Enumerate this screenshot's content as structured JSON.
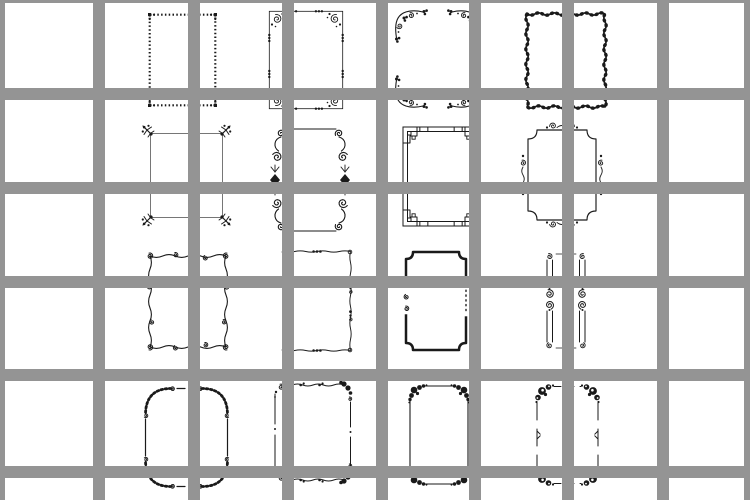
{
  "canvas": {
    "width": 750,
    "height": 500,
    "background": "#ffffff",
    "ink": "#1a1a1a",
    "thin_line": "#4a4a4a"
  },
  "grid_overlay": {
    "description": "opaque gray window-pane grid drawn on top of the clipart sheet",
    "color": "#949494",
    "bar_thickness": 12,
    "vertical_bars_x": [
      -7,
      93,
      188,
      282,
      376,
      469,
      562,
      657,
      744
    ],
    "horizontal_bars_y": [
      -9,
      88,
      182,
      276,
      369,
      466
    ]
  },
  "sheet": {
    "description": "4x4 sheet of black ornamental vintage frame cliparts on white",
    "rows": 4,
    "columns": 4
  },
  "frames": [
    {
      "name": "frame-beaded-dotted",
      "kind": "bead_rect",
      "x": 148,
      "y": 13,
      "w": 69,
      "h": 94
    },
    {
      "name": "frame-corner-scroll-bead",
      "kind": "scroll_bead",
      "x": 268,
      "y": 10,
      "w": 76,
      "h": 100
    },
    {
      "name": "frame-floral-corner-vine",
      "kind": "vine_corners",
      "x": 393,
      "y": 8,
      "w": 89,
      "h": 102
    },
    {
      "name": "frame-leafy-wave-border",
      "kind": "leafy_wave",
      "x": 524,
      "y": 11,
      "w": 84,
      "h": 99
    },
    {
      "name": "frame-branch-corner",
      "kind": "branch_corners",
      "x": 141,
      "y": 124,
      "w": 91,
      "h": 103
    },
    {
      "name": "frame-s-scroll-diamond",
      "kind": "scroll_diamond",
      "x": 268,
      "y": 127,
      "w": 84,
      "h": 106
    },
    {
      "name": "frame-greek-key",
      "kind": "greek_key",
      "x": 402,
      "y": 126,
      "w": 78,
      "h": 101
    },
    {
      "name": "frame-notched-plaque",
      "kind": "plaque_scroll",
      "x": 518,
      "y": 121,
      "w": 88,
      "h": 108
    },
    {
      "name": "frame-curly-squiggle",
      "kind": "squiggle_curls",
      "x": 144,
      "y": 250,
      "w": 88,
      "h": 103
    },
    {
      "name": "frame-wavy-bead",
      "kind": "wavy_bead",
      "x": 280,
      "y": 248,
      "w": 74,
      "h": 106
    },
    {
      "name": "frame-bold-notched",
      "kind": "bold_notched",
      "x": 403,
      "y": 250,
      "w": 66,
      "h": 102
    },
    {
      "name": "frame-double-scroll-bars",
      "kind": "scroll_bars",
      "x": 536,
      "y": 250,
      "w": 60,
      "h": 102
    },
    {
      "name": "frame-ruffled-corner",
      "kind": "ruffle_corners",
      "x": 143,
      "y": 386,
      "w": 87,
      "h": 103
    },
    {
      "name": "frame-leafy-flourish",
      "kind": "leafy_flourish",
      "x": 272,
      "y": 378,
      "w": 82,
      "h": 109
    },
    {
      "name": "frame-acanthus-corner",
      "kind": "bloom_corners",
      "x": 407,
      "y": 383,
      "w": 64,
      "h": 104
    },
    {
      "name": "frame-rosette-corner",
      "kind": "rosette_corners",
      "x": 534,
      "y": 383,
      "w": 67,
      "h": 104
    }
  ]
}
